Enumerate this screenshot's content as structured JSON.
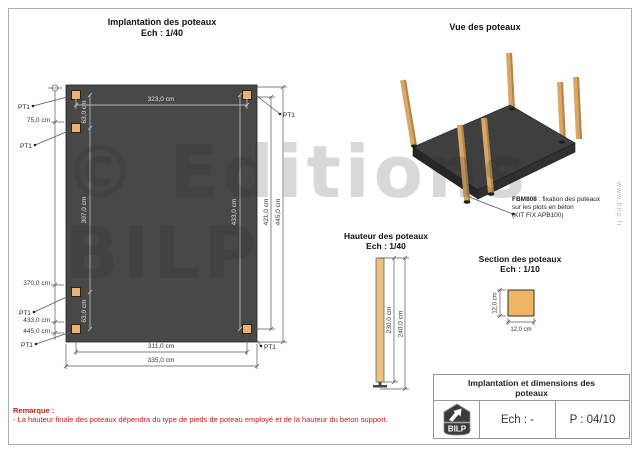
{
  "plan": {
    "title": "Implantation des poteaux",
    "scale": "Ech : 1/40",
    "pt": "PT1",
    "dims": {
      "top": "323,0 cm",
      "gap_top": "63,0 cm",
      "span_left": "307,0 cm",
      "gap_bottom": "63,0 cm",
      "right_inner": "433,0 cm",
      "right_outer_a": "421,0 cm",
      "right_outer_b": "445,0 cm",
      "bottom_inner": "311,0 cm",
      "bottom_outer": "335,0 cm"
    },
    "left_levels": [
      "75,0 cm",
      "370,0 cm",
      "433,0 cm",
      "445,0 cm"
    ]
  },
  "view3d": {
    "title": "Vue des poteaux",
    "note_code": "FBM808",
    "note_rest": " : fixation des poteaux",
    "note_line2": "sur les plots en béton",
    "note_line3": "(KIT FIX APB100)"
  },
  "hfig": {
    "title": "Hauteur des poteaux",
    "scale": "Ech : 1/40",
    "dim_post": "230,0 cm",
    "dim_total": "240,0 cm"
  },
  "sfig": {
    "title": "Section des poteaux",
    "scale": "Ech : 1/10",
    "dim_h": "12,0 cm",
    "dim_w": "12,0 cm"
  },
  "tb": {
    "title": "Implantation et dimensions des poteaux",
    "logo": "BILP",
    "scale": "Ech : -",
    "page": "P : 04/10"
  },
  "remark": {
    "label": "Remarque :",
    "text": "- La hauteur finale des poteaux dépendra du type de pieds de poteau employé et de la hauteur du beton support."
  },
  "wm": {
    "text": "© Editions BILP",
    "url": "www.bilp.fr"
  }
}
